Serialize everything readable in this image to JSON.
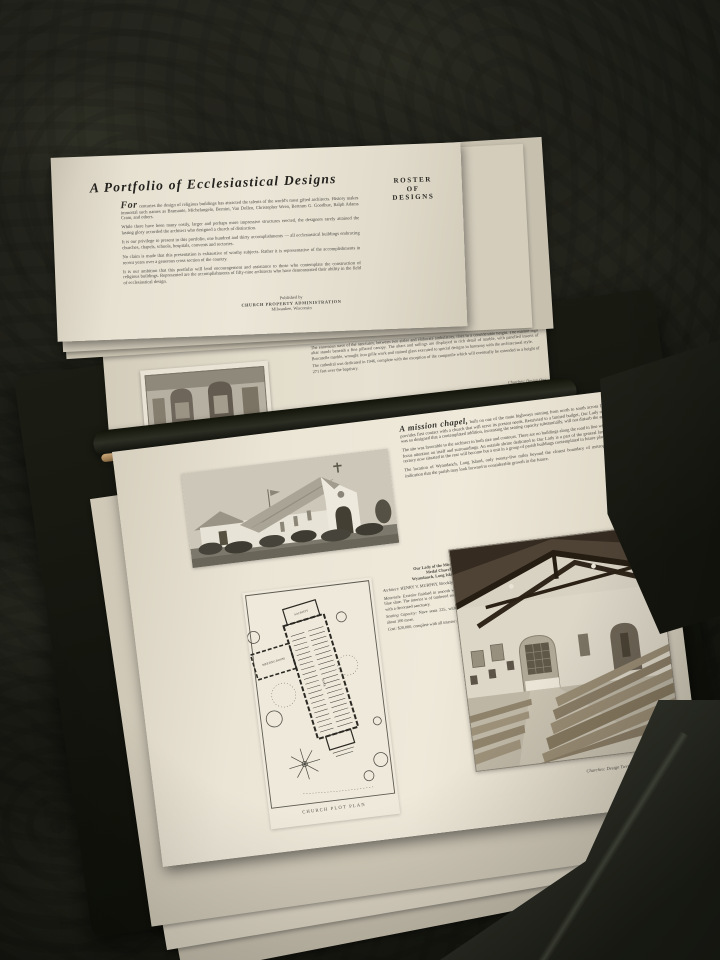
{
  "title_page": {
    "title": "A Portfolio of Ecclesiastical Designs",
    "lead_word": "For",
    "paragraphs": [
      "centuries the design of religious buildings has attracted the talents of the world's most gifted architects. History makes immortal such names as Bramante, Michelangelo, Bernini, Van Dollen, Christopher Wren, Bertram G. Goodhue, Ralph Adams Cram, and others.",
      "While there have been many costly, larger and perhaps more impressive structures erected, the designers rarely attained the lasting glory accorded the architect who designed a church of distinction.",
      "It is our privilege to present in this portfolio, one hundred and thirty accomplishments — all ecclesiastical buildings embracing churches, chapels, schools, hospitals, convents and rectories.",
      "No claim is made that this presentation is exhaustive of worthy subjects. Rather it is representative of the accomplishments in recent years over a generous cross section of the country.",
      "It is our ambition that this portfolio will lend encouragement and assistance to those who contemplate the construction of religious buildings. Represented are the accomplishments of fifty-nine architects who have demonstrated their ability in the field of ecclesiastical design."
    ],
    "roster": {
      "line1": "ROSTER",
      "line2": "OF",
      "line3": "DESIGNS"
    },
    "publisher": {
      "line1": "Published by",
      "line2": "CHURCH PROPERTY ADMINISTRATION",
      "line3": "Milwaukee, Wisconsin"
    }
  },
  "cathedral_page": {
    "paragraphs": [
      "The enormous nave of the sanctuary, between two aisles and elaborate ambulatory, rises to a considerable height. The marble high altar stands beneath a fine pillared canopy. The altars and railings are displayed in rich detail of marble, with panelled inserts of Brocatelle marble, wrought iron grille work and stained glass executed to special designs in harmony with the architectural style.",
      "The cathedral was dedicated in 1946, complete with the exception of the campanile which will eventually be extended to a height of 271 feet over the baptistry."
    ],
    "caption": "Churches: Design One"
  },
  "chapel_page": {
    "lead_in": "A mission chapel,",
    "paragraphs": [
      "built on one of the main highways running from north to south across Long Island, New York, provides first contact with a church that will serve its present needs. Restricted to a limited budget, Our Lady of the Miraculous Medal was so designed that a contemplated addition, increasing the seating capacity substantially, will not disturb the architectural plan.",
      "The site was favorable to the architect in both size and contours. There are no buildings along the road in line with the chapel, tending to focus attention on itself and surroundings. An outside shrine dedicated to Our Lady is a part of the general landscaping effect. A small rectory now situated in the rear will become but a unit in a group of parish buildings contemplated in future plans.",
      "The location of Wyandanch, Long Island, only twenty-five miles beyond the closest boundary of metropolitan New York, is an indication that the parish may look forward to considerable growth in the future."
    ],
    "specs": {
      "church_name_1": "Our Lady of the Miraculous",
      "church_name_2": "Medal Church",
      "location": "Wyandanch, Long Island, N. Y.",
      "architect_label": "Architect:",
      "architect": "HENRY V. MURPHY, Brooklyn, N. Y.",
      "materials_label": "Materials:",
      "materials": "Exterior finished in smooth white plaster. Roof of gray-blue slate. The interior is of timbered roof with white plaster walls, with a decorated sanctuary.",
      "seating_label": "Seating Capacity:",
      "seating": "Nave seats 225, with the wing accommodating about 100 more.",
      "cost_label": "Cost:",
      "cost": "$20,000, complete with all interior appointments."
    },
    "plan_labels": {
      "sacristy": "SACRISTY",
      "wing": "MEETING ROOM",
      "nave": "NAVE"
    },
    "plan_caption": "CHURCH PLOT PLAN",
    "page_caption": "Churches: Design Twenty"
  }
}
